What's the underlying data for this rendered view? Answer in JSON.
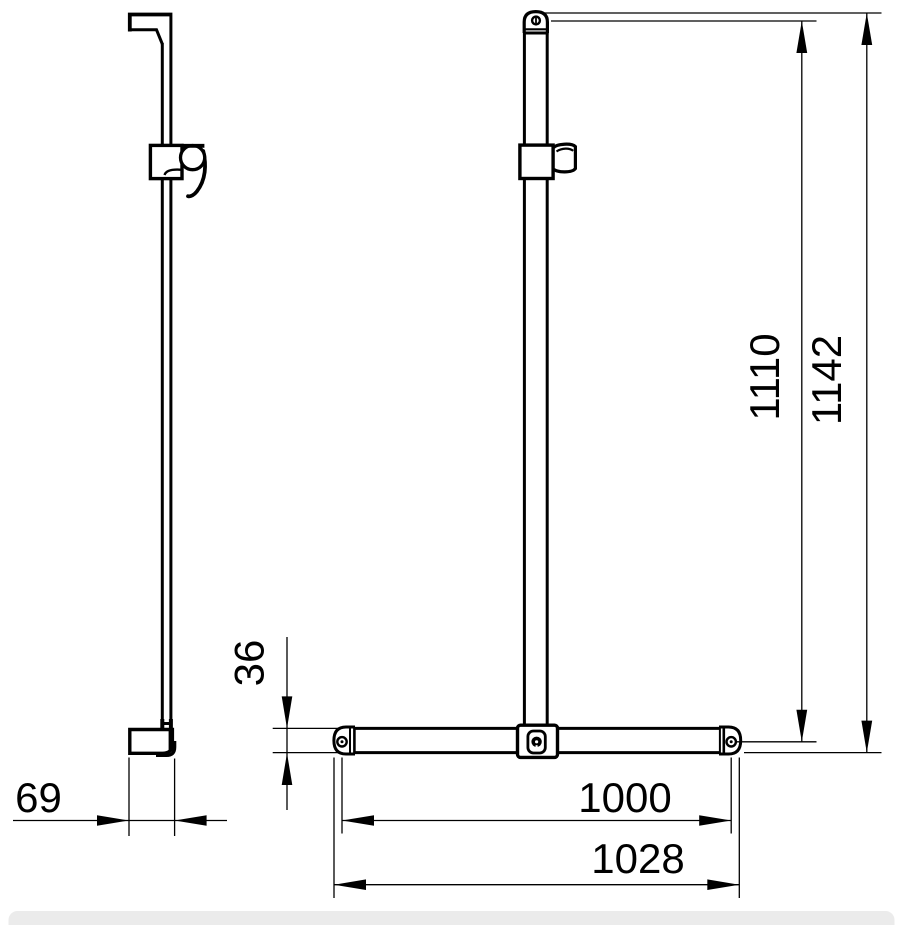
{
  "drawing": {
    "type": "technical-dimension-drawing",
    "subject": "shower-rail-with-crossbar",
    "colors": {
      "background": "#ffffff",
      "line": "#000000",
      "footer_bar": "#ebebeb"
    },
    "dims": {
      "side_depth": "69",
      "crossbar_height": "36",
      "height_to_hole": "1110",
      "overall_height": "1142",
      "hole_spacing": "1000",
      "crossbar_length": "1028"
    }
  }
}
